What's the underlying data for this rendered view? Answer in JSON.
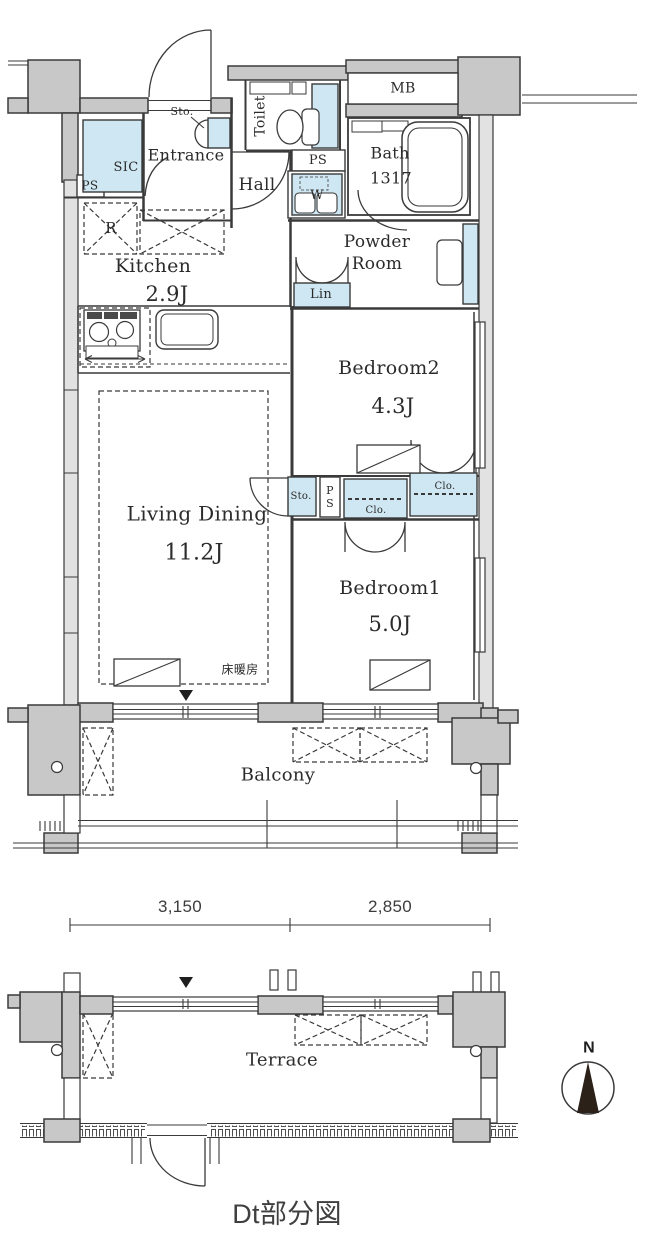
{
  "colors": {
    "wall": "#c8c8c8",
    "light_wall": "#e2e2e2",
    "closet_blue": "#cfe7f2",
    "line": "#3a3a3a",
    "compass": "#2c2119"
  },
  "labels": {
    "mb": "MB",
    "sto_entrance": "Sto.",
    "toilet": "Toilet",
    "sic": "SIC",
    "ps_left": "PS",
    "entrance": "Entrance",
    "hall": "Hall",
    "ps_top": "PS",
    "washer": "W",
    "bath": "Bath",
    "bath_size": "1317",
    "powder1": "Powder",
    "powder2": "Room",
    "lin": "Lin",
    "kitchen": "Kitchen",
    "kitchen_size": "2.9J",
    "fridge": "R",
    "bedroom2": "Bedroom2",
    "bedroom2_size": "4.3J",
    "living": "Living Dining",
    "living_size": "11.2J",
    "sto_living": "Sto.",
    "ps_mid": "PS",
    "clo_lower": "Clo.",
    "clo_upper": "Clo.",
    "floor_heating": "床暖房",
    "bedroom1": "Bedroom1",
    "bedroom1_size": "5.0J",
    "balcony": "Balcony",
    "terrace": "Terrace",
    "dim_left": "3,150",
    "dim_right": "2,850",
    "north": "N",
    "caption": "Dt部分図"
  }
}
